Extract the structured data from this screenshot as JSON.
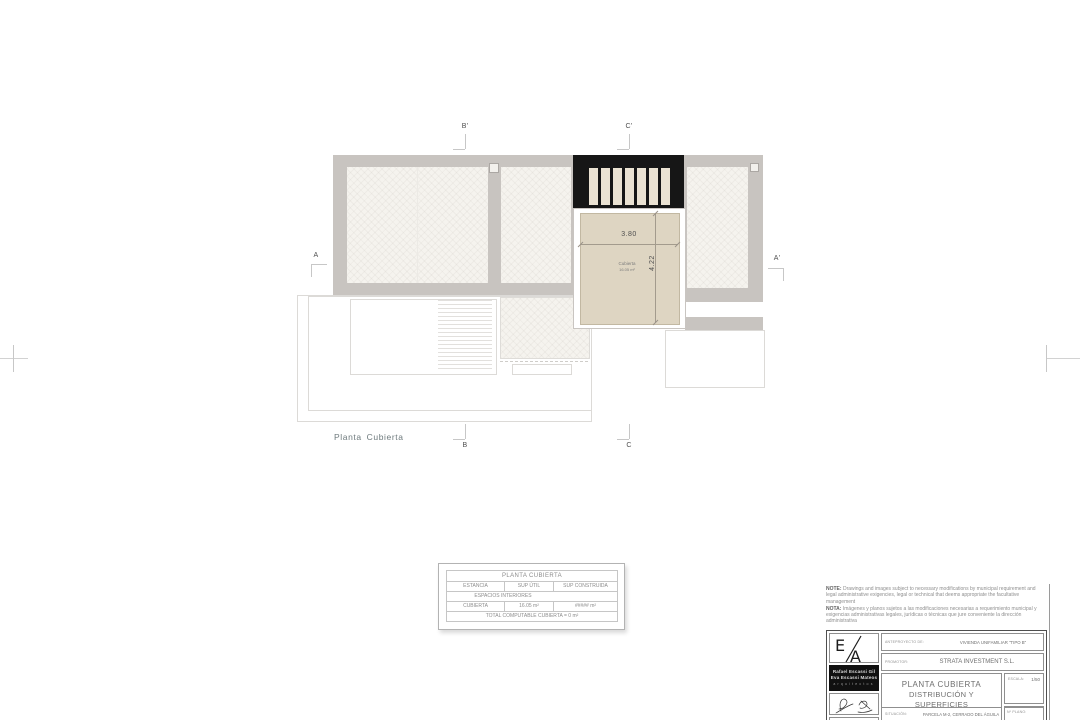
{
  "sheet": {
    "plan_label": "Planta Cubierta",
    "markers": {
      "top_left": "B'",
      "top_right": "C'",
      "left": "A",
      "right": "A'",
      "bottom_left": "B",
      "bottom_right": "C"
    },
    "room": {
      "name": "Cubierta",
      "area": "16.05 m²",
      "dim_width": "3.80",
      "dim_height": "4.22"
    }
  },
  "surface_table": {
    "title": "PLANTA CUBIERTA",
    "col_estancia": "ESTANCIA",
    "col_sup_util": "SUP ÚTIL",
    "col_sup_construida": "SUP CONSTRUIDA",
    "section_header": "ESPACIOS INTERIORES",
    "rows": [
      {
        "estancia": "CUBIERTA",
        "sup_util": "16.05 m²",
        "sup_construida": "##### m²"
      }
    ],
    "footer": "TOTAL COMPUTABLE CUBIERTA = 0 m²"
  },
  "notes": {
    "note_label": "NOTE:",
    "note_text": "Drawings and images subject to necessary modifications by municipal requirement and legal administrative exigencies, legal or technical that deems appropriate the facultative management",
    "nota_label": "NOTA:",
    "nota_text": "Imágenes y planos sujetos a las modificaciones necesarias a requerimiento municipal y exigencias administrativas legales, jurídicas o técnicas que jure conveniente la dirección administrativa"
  },
  "title_block": {
    "logo_letter_e": "E",
    "logo_letter_a": "A",
    "architect_1": "Rafael Escassi Gil",
    "architect_2": "Eva Escassi Mateos",
    "architects_caption": "arquitectos",
    "project_label": "ANTEPROYECTO DE:",
    "project_value": "VIVIENDA UNIFAMILIAR \"TIPO B\"",
    "promoter_label": "PROMOTOR:",
    "promoter_value": "STRATA INVESTMENT S.L.",
    "drawing_title_1": "PLANTA CUBIERTA",
    "drawing_title_2": "DISTRIBUCIÓN Y SUPERFICIES",
    "scale_label": "ESCALA:",
    "scale_value": "1/50",
    "date_label": "FECHA:",
    "date_value": "MAYO 2021",
    "location_label": "SITUACIÓN:",
    "location_value": "PARCELA M-2, CERRADO DEL ÁGUILA",
    "plan_no_label": "Nº PLANO:"
  },
  "colors": {
    "roof_gray": "#c8c4c0",
    "pergola_black": "#161616",
    "roof_tan": "#ded5c2",
    "panel_offwhite": "#f5f3ee"
  }
}
